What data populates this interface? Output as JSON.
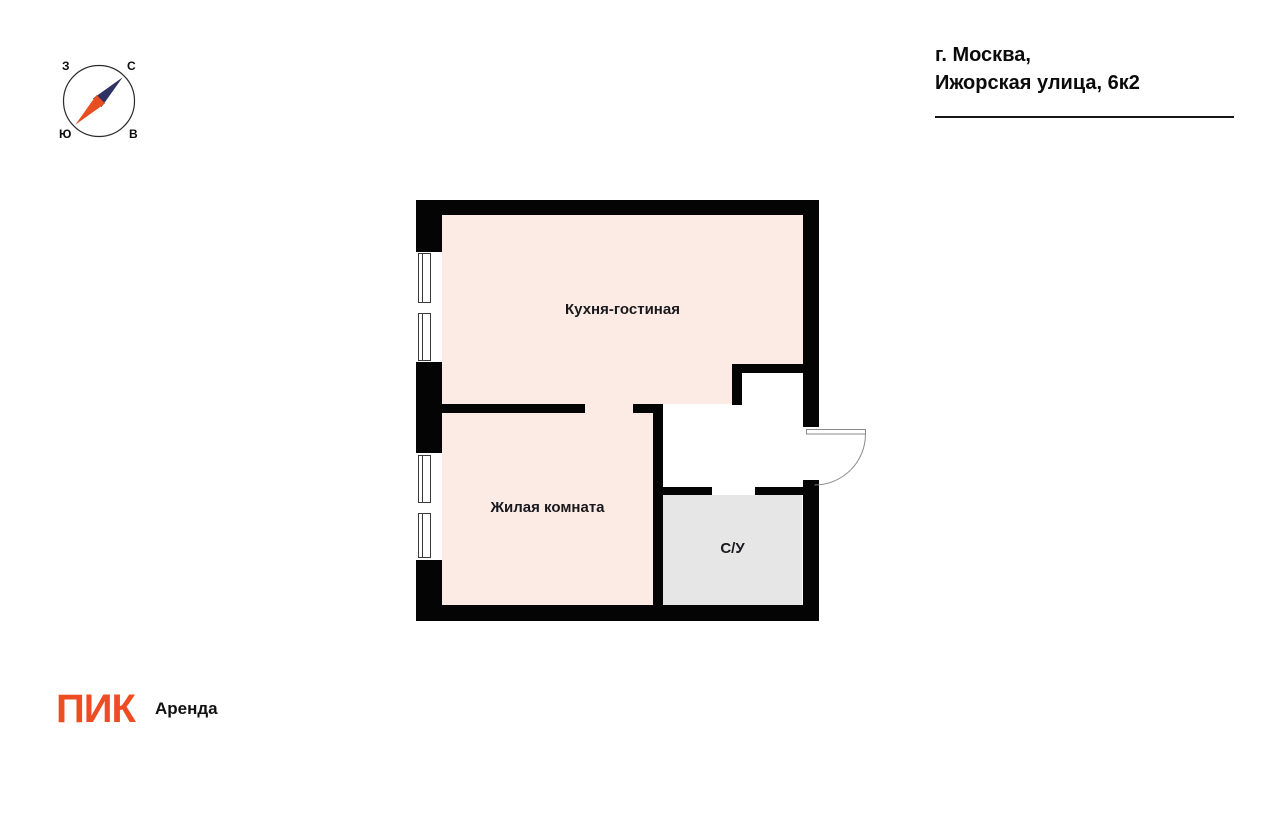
{
  "address": {
    "line1": "г. Москва,",
    "line2": "Ижорская улица, 6к2"
  },
  "compass": {
    "north": "С",
    "east": "В",
    "south": "Ю",
    "west": "З",
    "north_needle_color": "#2f3262",
    "south_needle_color": "#e84e1f"
  },
  "rooms": {
    "kitchen_living": {
      "label": "Кухня-гостиная",
      "fill": "#fcebe5"
    },
    "living": {
      "label": "Жилая комната",
      "fill": "#fcebe5"
    },
    "bathroom": {
      "label": "С/У",
      "fill": "#e6e6e7"
    }
  },
  "colors": {
    "walls": "#040404",
    "logo_orange": "#ee4d23"
  },
  "logo": {
    "brand": "ПИК",
    "product": "Аренда"
  }
}
